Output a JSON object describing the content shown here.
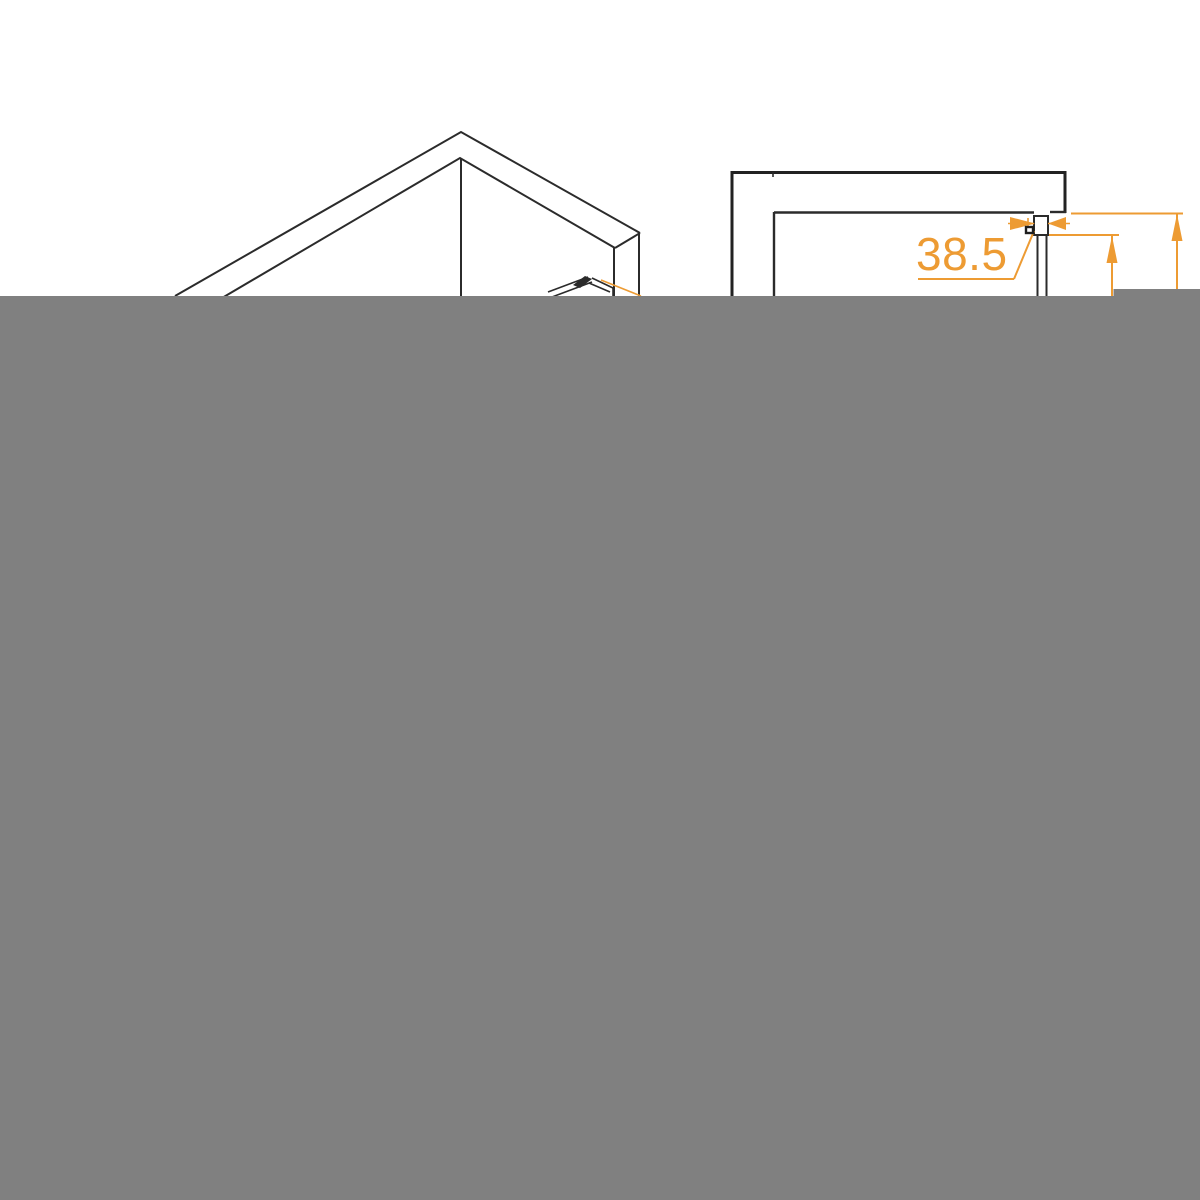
{
  "colors": {
    "background": "#ffffff",
    "drawing_line": "#2b2b2b",
    "accent_orange": "#ed9b33",
    "overlay_gray": "#808080"
  },
  "diagram": {
    "dimension_label": "38.5"
  }
}
